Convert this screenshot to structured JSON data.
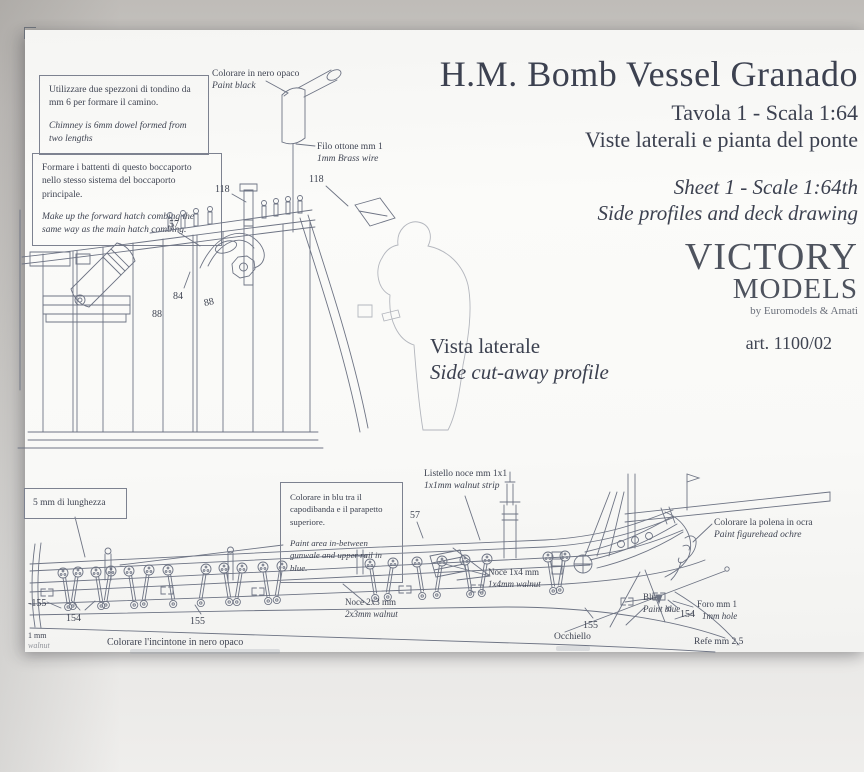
{
  "colors": {
    "paper": "#fafaf8",
    "background": "#cfccc9",
    "ink": "#3f4452",
    "drawing_line": "#6e7484",
    "logo_dark": "#575c66",
    "logo_light": "#a7acb9"
  },
  "title_block": {
    "title": "H.M. Bomb Vessel Granado",
    "line1_it": "Tavola 1 - Scala 1:64",
    "line2_it": "Viste laterali e pianta del ponte",
    "line1_en": "Sheet 1 - Scale 1:64th",
    "line2_en": "Side profiles and deck drawing"
  },
  "logo": {
    "brand_top": "VICTORY",
    "brand_bottom": "MODELS",
    "byline": "by Euromodels & Amati",
    "article": "art. 1100/02"
  },
  "section": {
    "it": "Vista laterale",
    "en": "Side cut-away profile"
  },
  "notes": {
    "chimney": {
      "it": "Utilizzare due spezzoni di tondino da mm 6 per formare il camino.",
      "en": "Chimney is 6mm dowel formed from two lengths"
    },
    "hatch": {
      "it": "Formare i battenti di questo boccaporto nello stesso sistema del boccaporto principale.",
      "en": "Make up the forward hatch combing the same way as the main hatch combing."
    },
    "blue": {
      "it": "Colorare in blu tra il capodibanda e il parapetto superiore.",
      "en": "Paint area in-between gunwale and upper rail in blue."
    },
    "length": {
      "it": "5 mm di lunghezza"
    }
  },
  "labels": {
    "paint_black_it": "Colorare in nero opaco",
    "paint_black_en": "Paint black",
    "brass_wire_it": "Filo ottone mm 1",
    "brass_wire_en": "1mm Brass wire",
    "walnut_strip_it": "Listello noce mm 1x1",
    "walnut_strip_en": "1x1mm walnut strip",
    "figurehead_it": "Colorare la polena in ocra",
    "figurehead_en": "Paint figurehead ochre",
    "walnut_1x4_it": "Noce 1x4 mm",
    "walnut_1x4_en": "1x4mm walnut",
    "walnut_2x3_it": "Noce 2x3 mm",
    "walnut_2x3_en": "2x3mm walnut",
    "blue_it": "Blu",
    "blue_en": "Paint blue",
    "hole_it": "Foro mm 1",
    "hole_en": "1mm hole",
    "eyelet_it": "Occhiello",
    "thread_it": "Refe mm 2,5",
    "wale_black_it": "Colorare l'incintone in nero opaco",
    "edge_mm": "1 mm",
    "edge_walnut": "walnut"
  },
  "part_numbers": {
    "p57": "57",
    "p84": "84",
    "p88": "88",
    "p118": "118",
    "p154": "154",
    "p155": "155",
    "p155m": "-155"
  }
}
